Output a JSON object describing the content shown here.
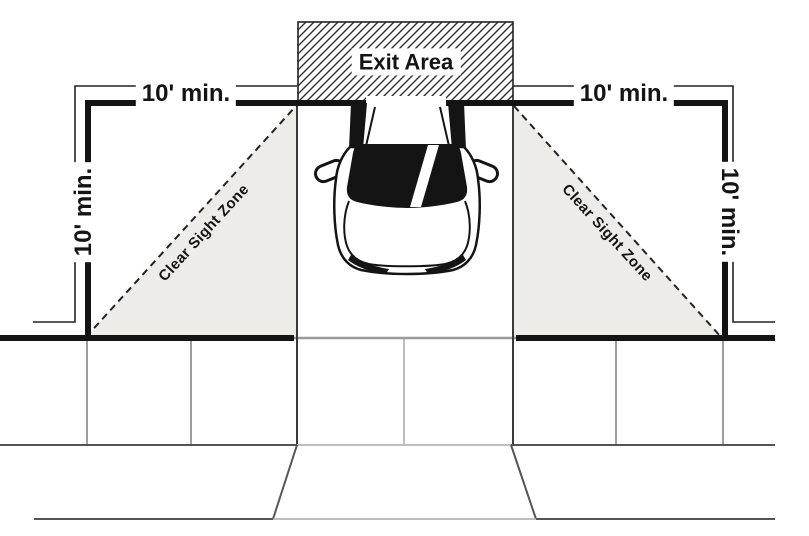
{
  "labels": {
    "exit_area": "Exit Area",
    "dim_top_left": "10' min.",
    "dim_top_right": "10' min.",
    "dim_left": "10' min.",
    "dim_right": "10' min.",
    "clear_sight_zone_left": "Clear Sight Zone",
    "clear_sight_zone_right": "Clear Sight Zone"
  },
  "colors": {
    "line": "#141414",
    "thin": "#222222",
    "edge": "#3a3a3a",
    "hatch": "#303030",
    "zone_fill": "#edece9",
    "curb_gray": "#9a9a9a",
    "grid_dark": "#555555",
    "grid_mid": "#7d7d7d",
    "grid_light": "#a9a9a9"
  }
}
